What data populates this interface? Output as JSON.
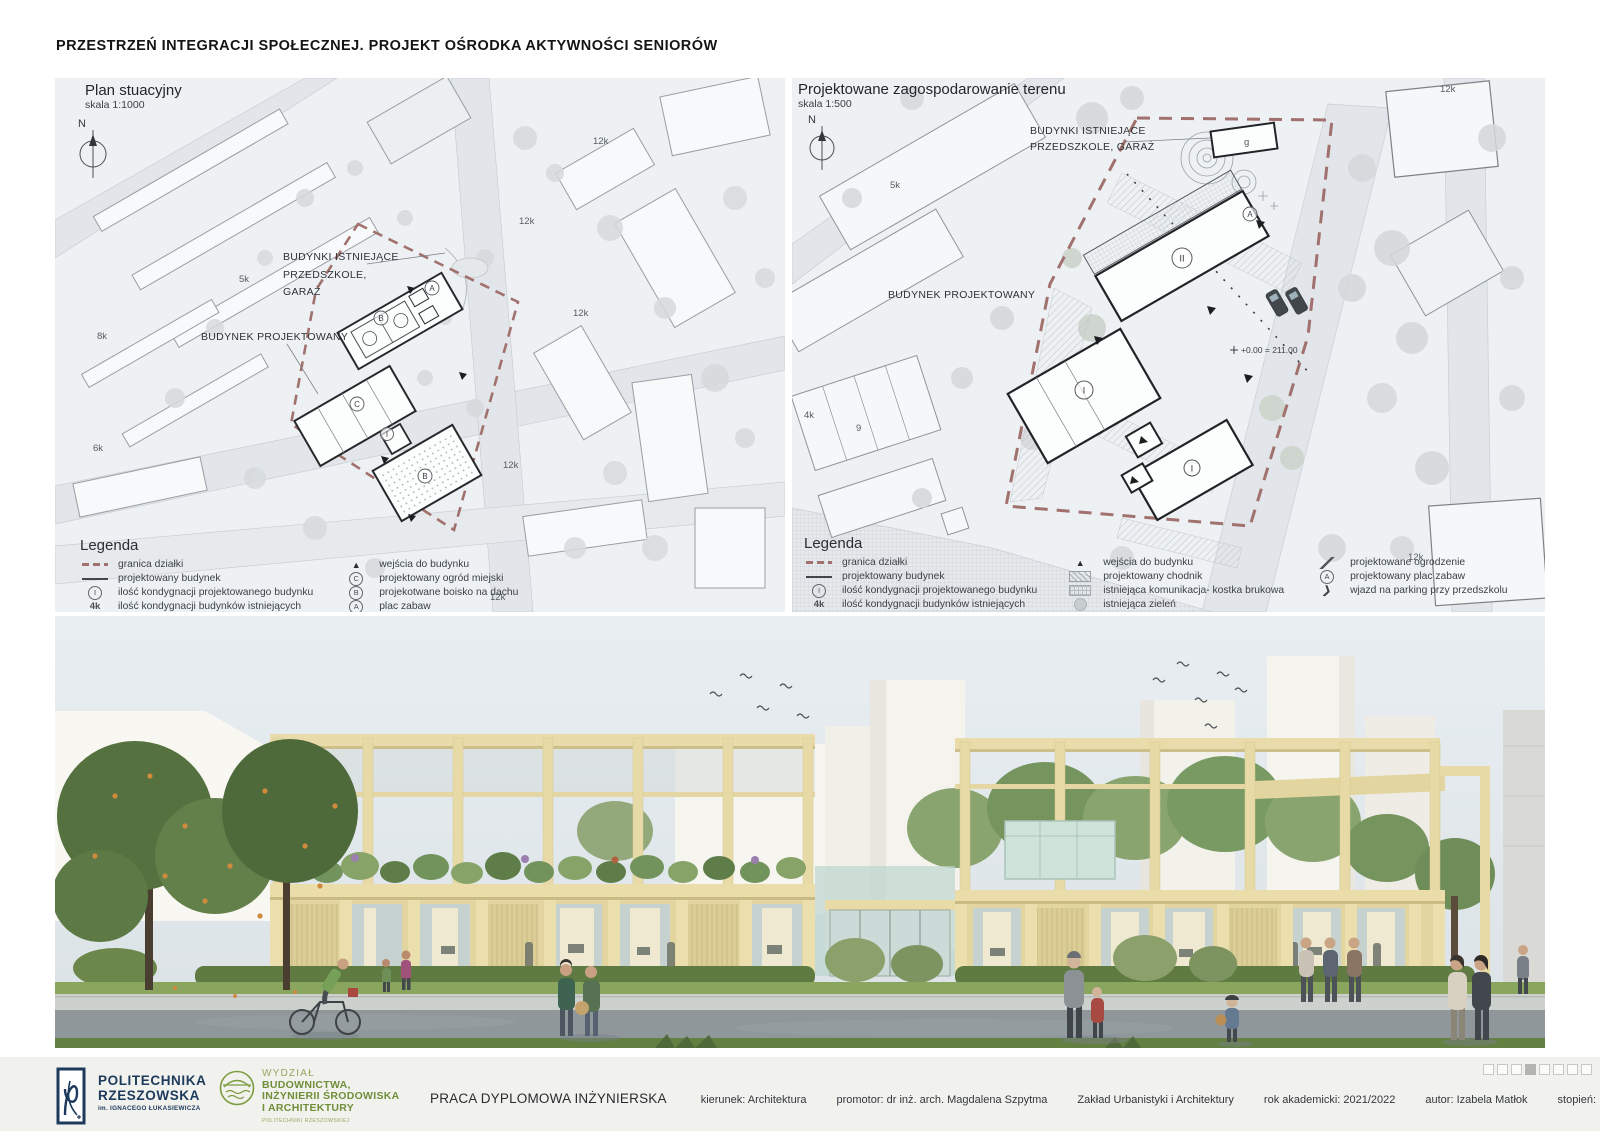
{
  "page": {
    "title": "PRZESTRZEŃ INTEGRACJI SPOŁECZNEJ. PROJEKT OŚRODKA AKTYWNOŚCI SENIORÓW"
  },
  "colors": {
    "site_boundary": "#a1716d",
    "university_navy": "#1d3a5c",
    "faculty_green": "#7d9c40",
    "building_wood": "#e6d9a6",
    "map_background": "#edf1f4"
  },
  "plans": {
    "left": {
      "title": "Plan stuacyjny",
      "scale": "skala 1:1000",
      "compass": "N",
      "annotations": {
        "existing_line1": "BUDYNKI ISTNIEJĄCE",
        "existing_line2": "PRZEDSZKOLE,",
        "existing_line3": "GARAŻ",
        "proposed": "BUDYNEK PROJEKTOWANY"
      },
      "small_labels": [
        "12k",
        "12k",
        "5k",
        "12k",
        "8k",
        "6k",
        "12k",
        "12k"
      ],
      "circled": [
        "A",
        "B",
        "C",
        "I",
        "B"
      ],
      "legend": {
        "title": "Legenda",
        "columns": [
          [
            {
              "symbol": "boundary-dashed",
              "label": "granica działki"
            },
            {
              "symbol": "line-solid",
              "label": "projektowany budynek"
            },
            {
              "symbol": "circle-letter",
              "glyph": "I",
              "label": "ilość kondygnacji projektowanego budynku"
            },
            {
              "symbol": "text",
              "glyph": "4k",
              "label": "ilość kondygnacji budynków istniejących"
            },
            {
              "symbol": "triangle",
              "label": "główne wejście do budynku"
            }
          ],
          [
            {
              "symbol": "triangle",
              "label": "wejścia do budynku"
            },
            {
              "symbol": "circle-letter",
              "glyph": "C",
              "label": "projektowany ogród miejski"
            },
            {
              "symbol": "circle-letter",
              "glyph": "B",
              "label": "projekotwane boisko na dachu"
            },
            {
              "symbol": "circle-letter",
              "glyph": "A",
              "label": "plac zabaw"
            },
            {
              "symbol": "line-double",
              "label": "projektowana komunikacja"
            }
          ]
        ]
      }
    },
    "right": {
      "title": "Projektowane zagospodarowanie terenu",
      "scale": "skala 1:500",
      "compass": "N",
      "annotations": {
        "existing_line1": "BUDYNKI ISTNIEJĄCE",
        "existing_line2": "PRZEDSZKOLE, GARAŻ",
        "proposed": "BUDYNEK PROJEKTOWANY",
        "level": "+0.00 = 211.00"
      },
      "small_labels": [
        "12k",
        "g",
        "5k",
        "4k",
        "9",
        "12k"
      ],
      "circled": [
        "A",
        "II",
        "I",
        "I"
      ],
      "legend": {
        "title": "Legenda",
        "columns": [
          [
            {
              "symbol": "boundary-dashed",
              "label": "granica działki"
            },
            {
              "symbol": "line-solid",
              "label": "projektowany budynek"
            },
            {
              "symbol": "circle-letter",
              "glyph": "I",
              "label": "ilość kondygnacji projektowanego budynku"
            },
            {
              "symbol": "text",
              "glyph": "4k",
              "label": "ilość kondygnacji budynków istniejących"
            },
            {
              "symbol": "triangle",
              "label": "główne wejście do budynku"
            }
          ],
          [
            {
              "symbol": "triangle",
              "label": "wejścia do budynku"
            },
            {
              "symbol": "hatch",
              "label": "projektowany chodnik"
            },
            {
              "symbol": "grid",
              "label": "istniejąca komunikacja- kostka brukowa"
            },
            {
              "symbol": "tree-gray",
              "label": "istniejąca zieleń"
            },
            {
              "symbol": "tree-green",
              "label": "projektowana zieleń"
            }
          ],
          [
            {
              "symbol": "fence",
              "label": "projektowane ogrodzenie"
            },
            {
              "symbol": "circle-letter",
              "glyph": "A",
              "label": "projektowany plac zabaw"
            },
            {
              "symbol": "arrow",
              "label": "wjazd na parking przy przedszkolu"
            }
          ]
        ]
      }
    }
  },
  "footer": {
    "university": {
      "name_line1": "POLITECHNIKA",
      "name_line2": "RZESZOWSKA",
      "subtitle": "im. IGNACEGO ŁUKASIEWICZA"
    },
    "faculty": {
      "line1": "WYDZIAŁ",
      "line2": "BUDOWNICTWA,",
      "line3": "INŻYNIERII ŚRODOWISKA",
      "line4": "I ARCHITEKTURY",
      "subtitle": "POLITECHNIKI RZESZOWSKIEJ"
    },
    "project_type": "PRACA DYPLOMOWA INŻYNIERSKA",
    "details": [
      "kierunek: Architektura",
      "promotor: dr inż. arch. Magdalena Szpytma",
      "Zakład Urbanistyki i Architektury",
      "rok akademicki: 2021/2022",
      "autor: Izabela Matłok",
      "stopień: I",
      "rok: 4",
      "semestr: 7"
    ],
    "page_indicator": {
      "count": 8,
      "active_index": 3
    }
  }
}
